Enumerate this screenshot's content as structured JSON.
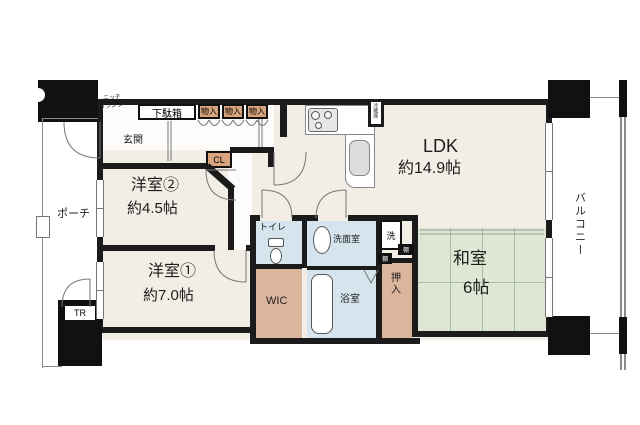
{
  "plan": {
    "rooms": {
      "ldk": {
        "name": "LDK",
        "size": "約14.9帖"
      },
      "western2": {
        "name": "洋室②",
        "size": "約4.5帖"
      },
      "western1": {
        "name": "洋室①",
        "size": "約7.0帖"
      },
      "japanese": {
        "name": "和室",
        "size": "6帖"
      },
      "entrance": {
        "name": "玄関"
      },
      "porch": {
        "name": "ポーチ"
      },
      "balcony": {
        "name": "バルコニー"
      },
      "toilet": {
        "name": "トイレ"
      },
      "washroom": {
        "name": "洗面室"
      },
      "bathroom": {
        "name": "浴室"
      },
      "walk_in_closet": {
        "name": "WIC"
      }
    },
    "storage": {
      "shoe_cabinet": "下駄箱",
      "hall_closet": "CL",
      "storage_box": "物入",
      "futon_closet": "押入",
      "shelf": "棚",
      "laundry": "洗",
      "trunk_room": "TR",
      "refrigerator": "冷蔵庫",
      "niche_counter": [
        "ニッチ",
        "カウンター"
      ]
    },
    "colors": {
      "wall": "#1b1b1b",
      "floor": "#f2eee5",
      "tatami": "#dde7d4",
      "wet_area": "#d6e4ee",
      "storage_tan": "#d9a47e",
      "closet_tan": "#dbb59c",
      "line": "#777777"
    }
  }
}
